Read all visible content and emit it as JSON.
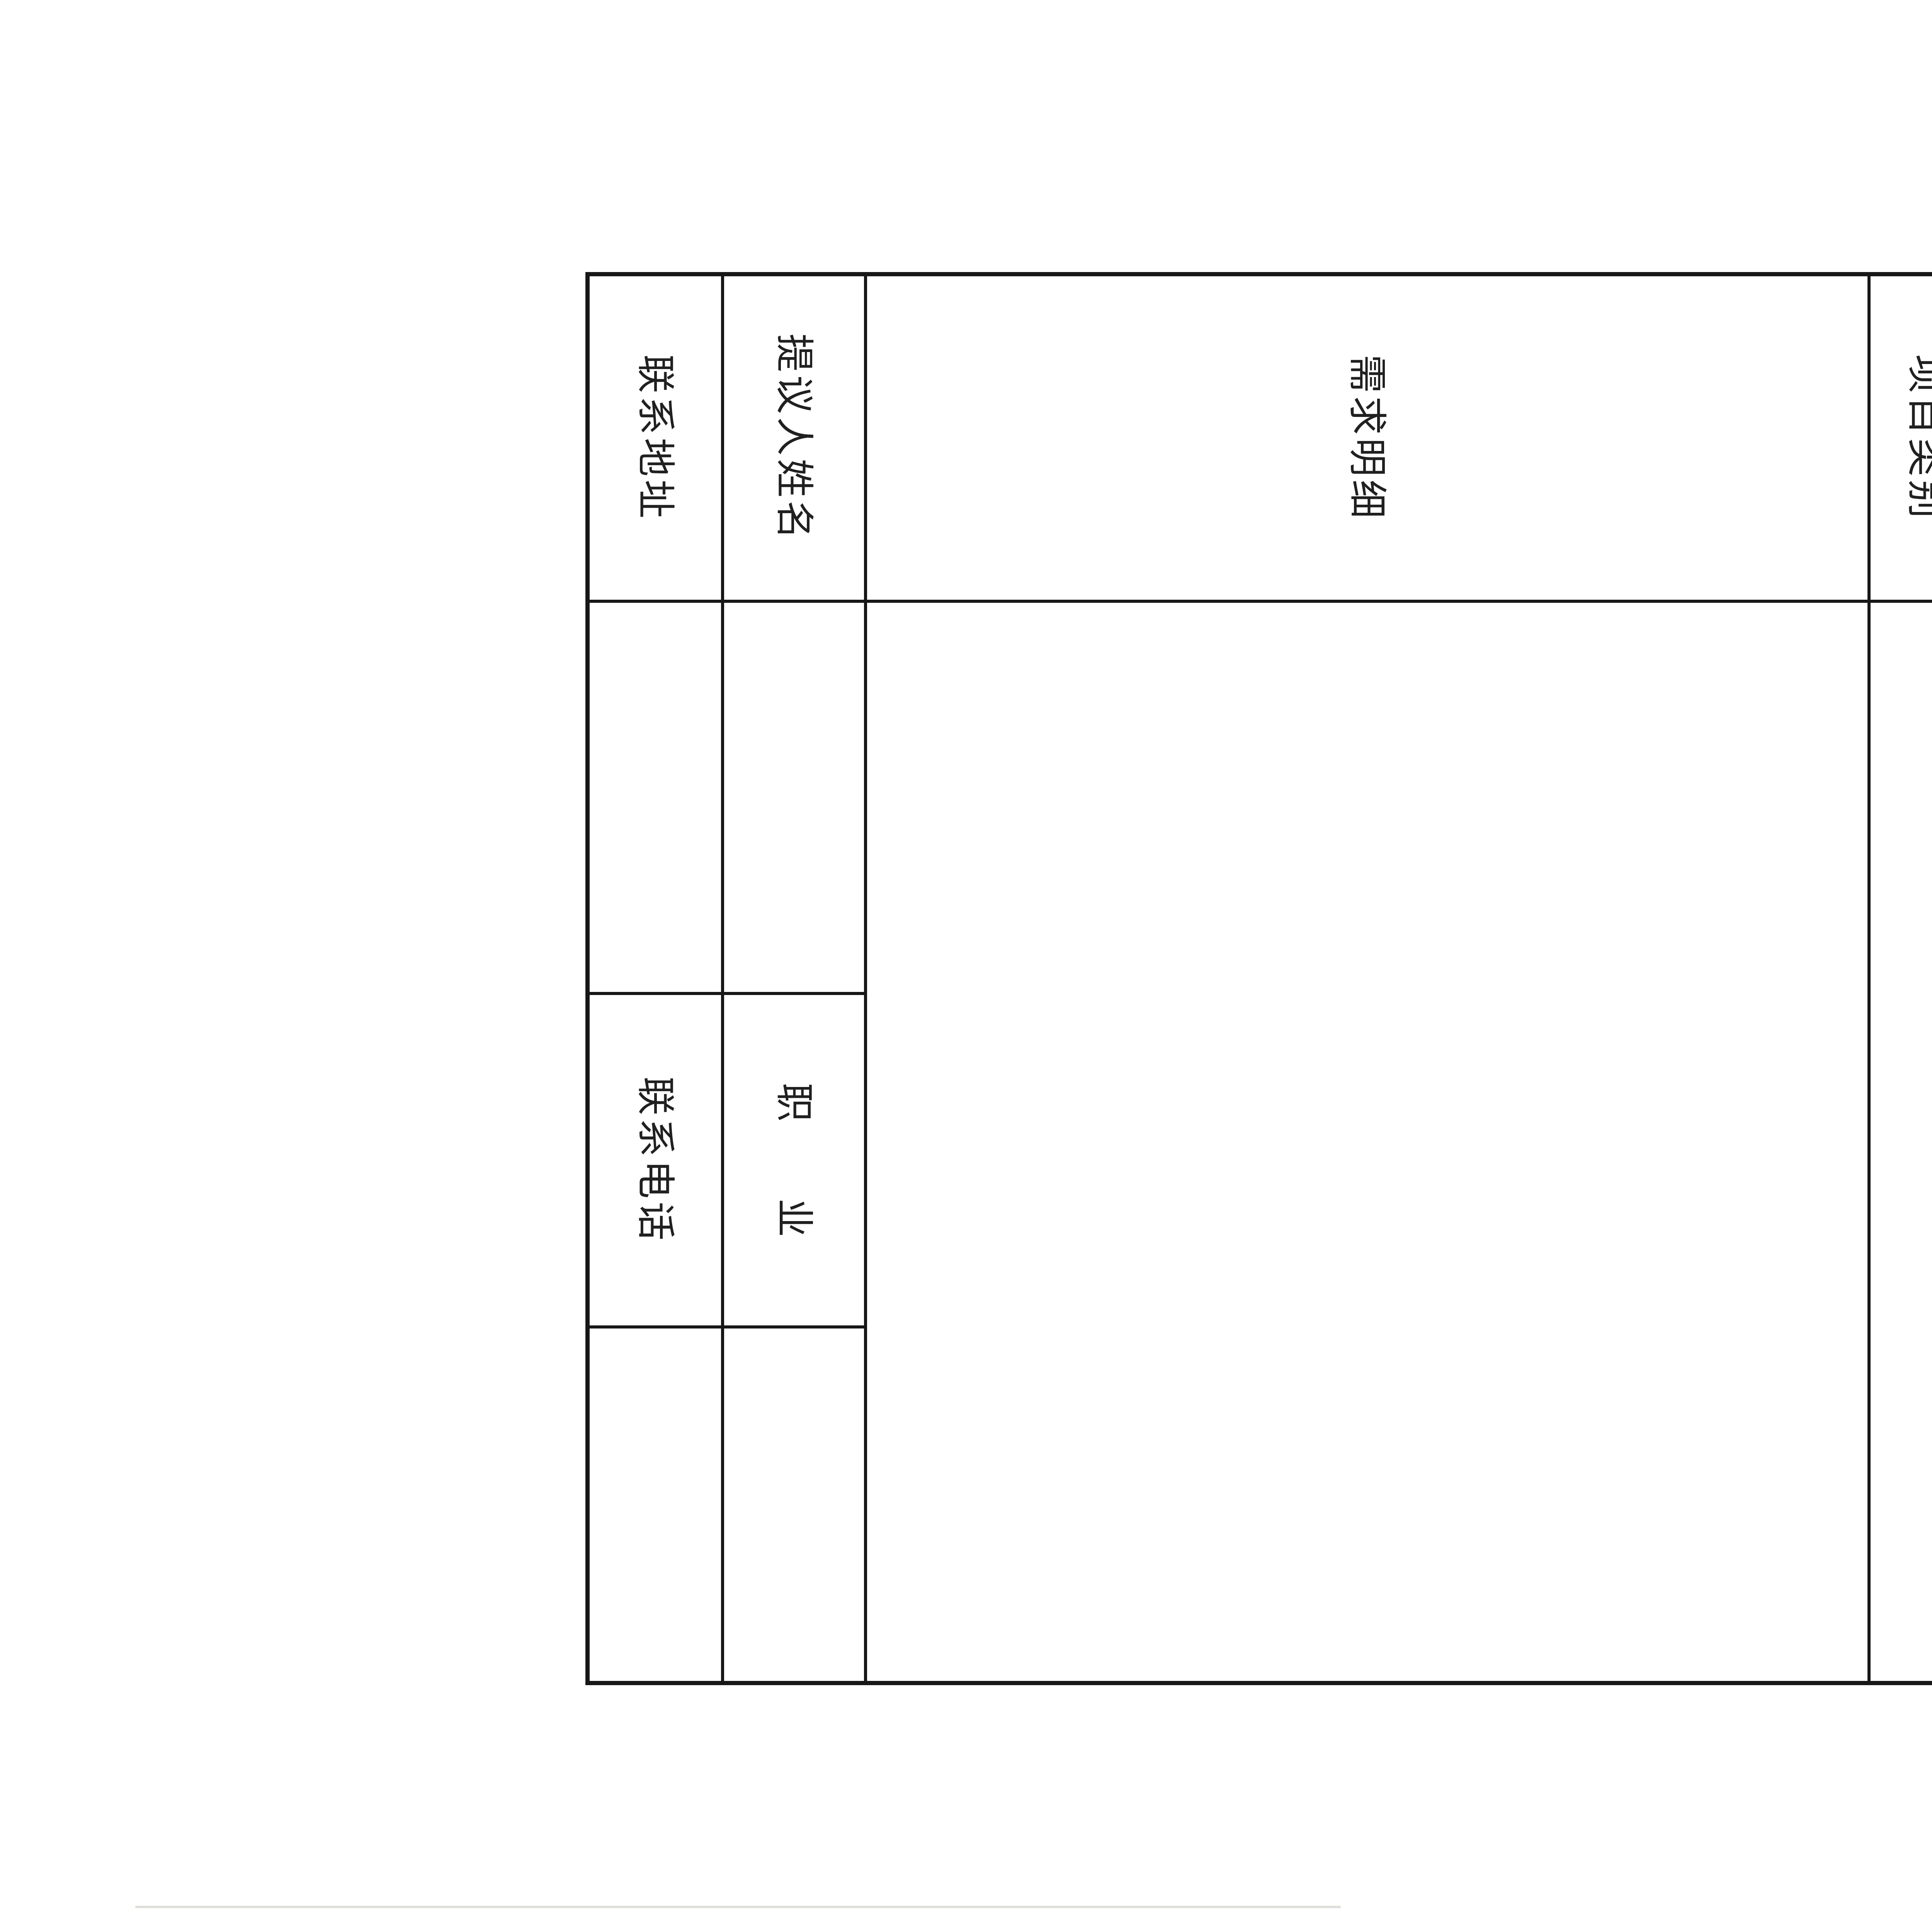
{
  "page": {
    "title": "航城街道社区“民生微实事”项目需求征集表",
    "header": {
      "community_label": "社区",
      "community_blank": "",
      "time_label": "时间:",
      "time_blank": ""
    },
    "table": {
      "rows": [
        {
          "label": "项目需求",
          "value": ""
        },
        {
          "label": "项目类别",
          "value": ""
        },
        {
          "label": "需求明细",
          "value": ""
        },
        {
          "label": "提议人姓名",
          "value": "",
          "label2": "职业",
          "value2": ""
        },
        {
          "label": "联系地址",
          "value": "",
          "label2": "联系电话",
          "value2": ""
        }
      ]
    }
  },
  "colors": {
    "ink": "#1f1f1f",
    "table_line": "#171717",
    "paper": "#ffffff"
  }
}
